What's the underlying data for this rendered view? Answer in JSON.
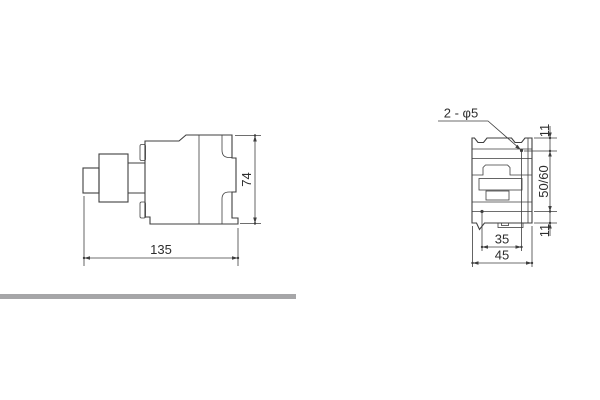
{
  "drawing": {
    "colors": {
      "background": "#ffffff",
      "line": "#3f3f3f",
      "text": "#2e2e2e",
      "divider_bar": "#a6a6a8"
    },
    "side_view": {
      "width_mm": "135",
      "height_mm": "74"
    },
    "front_view": {
      "hole_callout": "2 - φ5",
      "top_offset_mm": "11",
      "rail_spacing_mm": "50/60",
      "bottom_offset_mm": "11",
      "hole_spacing_mm": "35",
      "width_mm": "45"
    }
  }
}
